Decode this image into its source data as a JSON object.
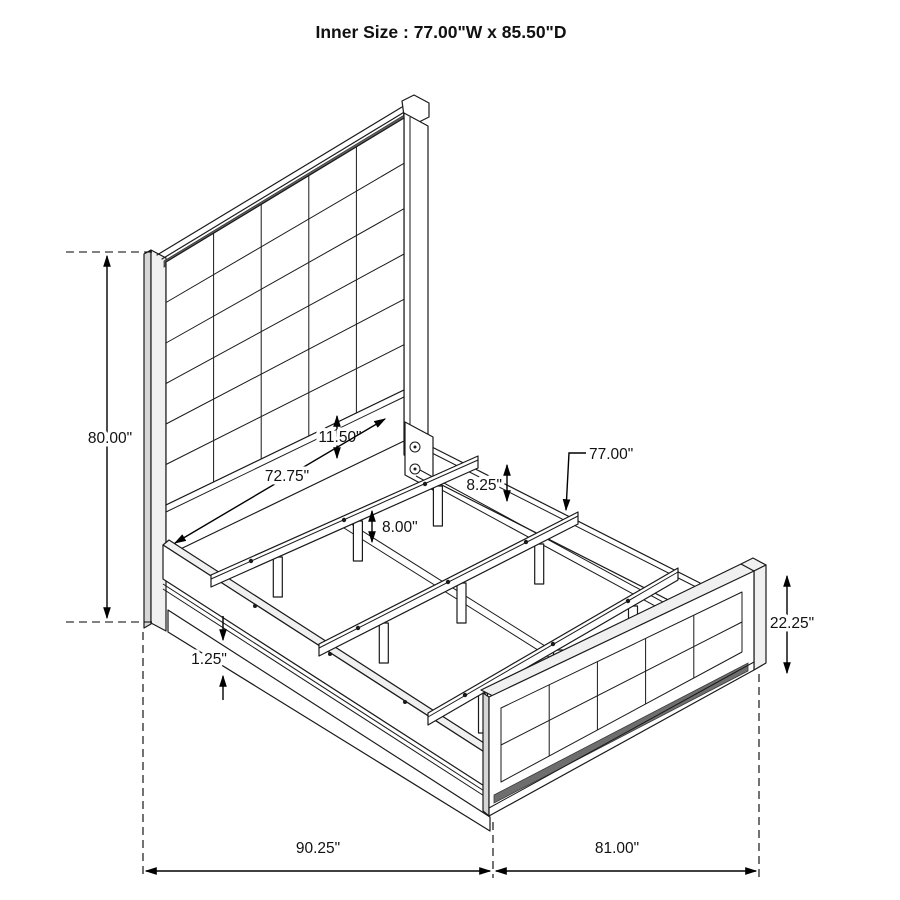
{
  "title": "Inner Size : 77.00\"W x 85.50\"D",
  "diagram_type": "isometric bed frame dimension drawing",
  "inner_size": {
    "width": "77.00\"",
    "depth": "85.50\""
  },
  "dims": {
    "headboard_height": "80.00\"",
    "head_rail_height": "11.50\"",
    "inner_width": "72.75\"",
    "slat_leg_height": "8.00\"",
    "rail_top_height": "8.25\"",
    "slat_length": "77.00\"",
    "footboard_height": "22.25\"",
    "base_trim_height": "1.25\"",
    "overall_depth": "90.25\"",
    "overall_width": "81.00\""
  },
  "colors": {
    "line": "#1a1a1a",
    "dimension": "#000000",
    "shade_dark": "#5f5f5f",
    "shade_mid": "#d6d6d6",
    "shade_light": "#f0f0f0",
    "background": "#ffffff"
  }
}
